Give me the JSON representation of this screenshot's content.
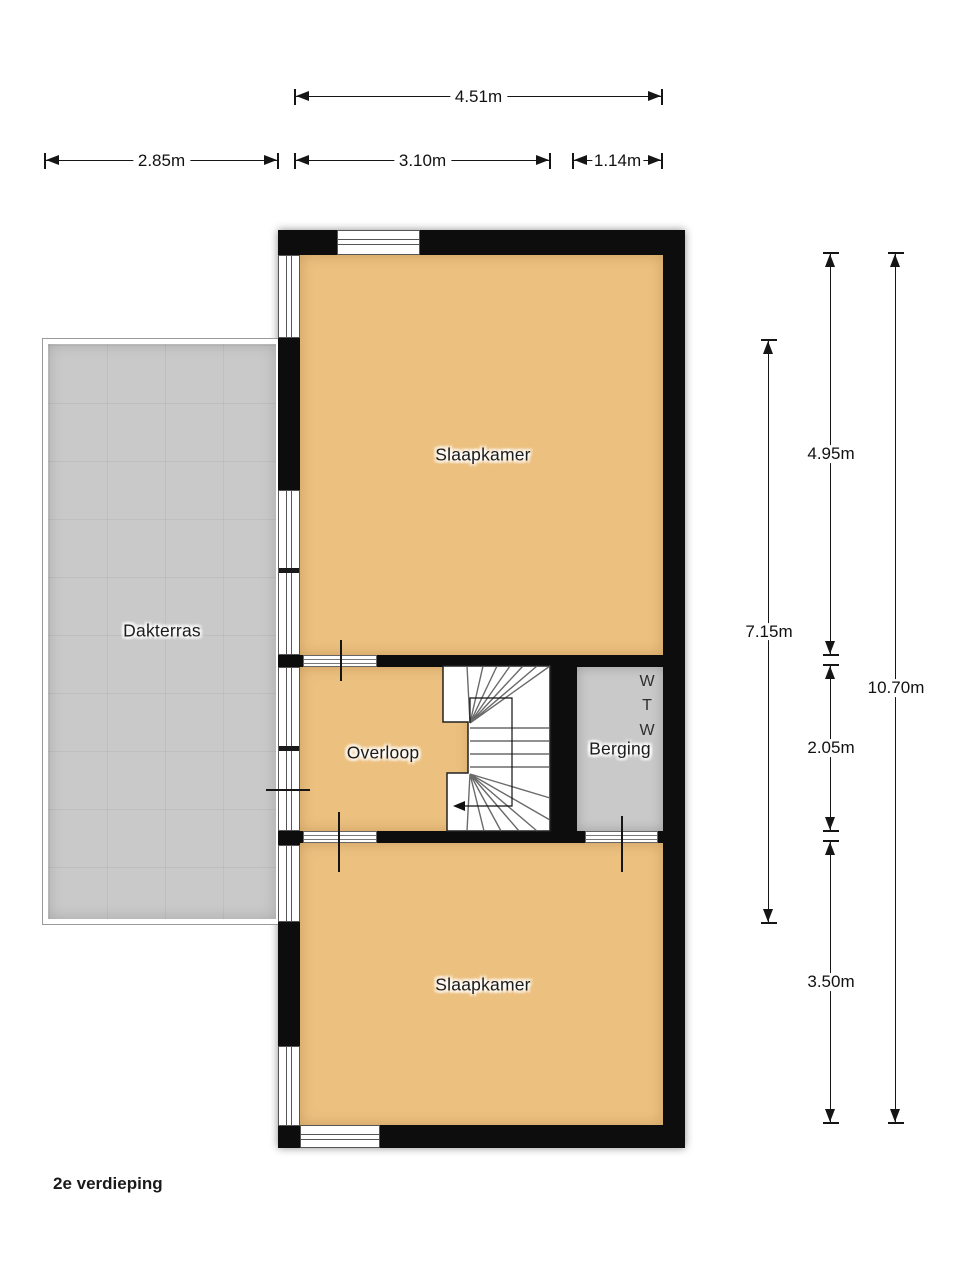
{
  "floor_label": "2e verdieping",
  "rooms": {
    "bedroom_top": "Slaapkamer",
    "bedroom_bottom": "Slaapkamer",
    "landing": "Overloop",
    "storage": "Berging",
    "roof_terrace": "Dakterras",
    "storage_letters": [
      "W",
      "T",
      "W"
    ]
  },
  "dimensions": {
    "top_width": "4.51m",
    "terrace_width": "2.85m",
    "room_width": "3.10m",
    "storage_width": "1.14m",
    "upper_room_height": "4.95m",
    "terrace_height": "7.15m",
    "middle_height": "2.05m",
    "lower_room_height": "3.50m",
    "total_height": "10.70m"
  },
  "colors": {
    "room_fill": "#ECC180",
    "storage_fill": "#C9C9C9",
    "terrace_fill": "#C9C9C9",
    "wall": "#0d0d0d"
  }
}
